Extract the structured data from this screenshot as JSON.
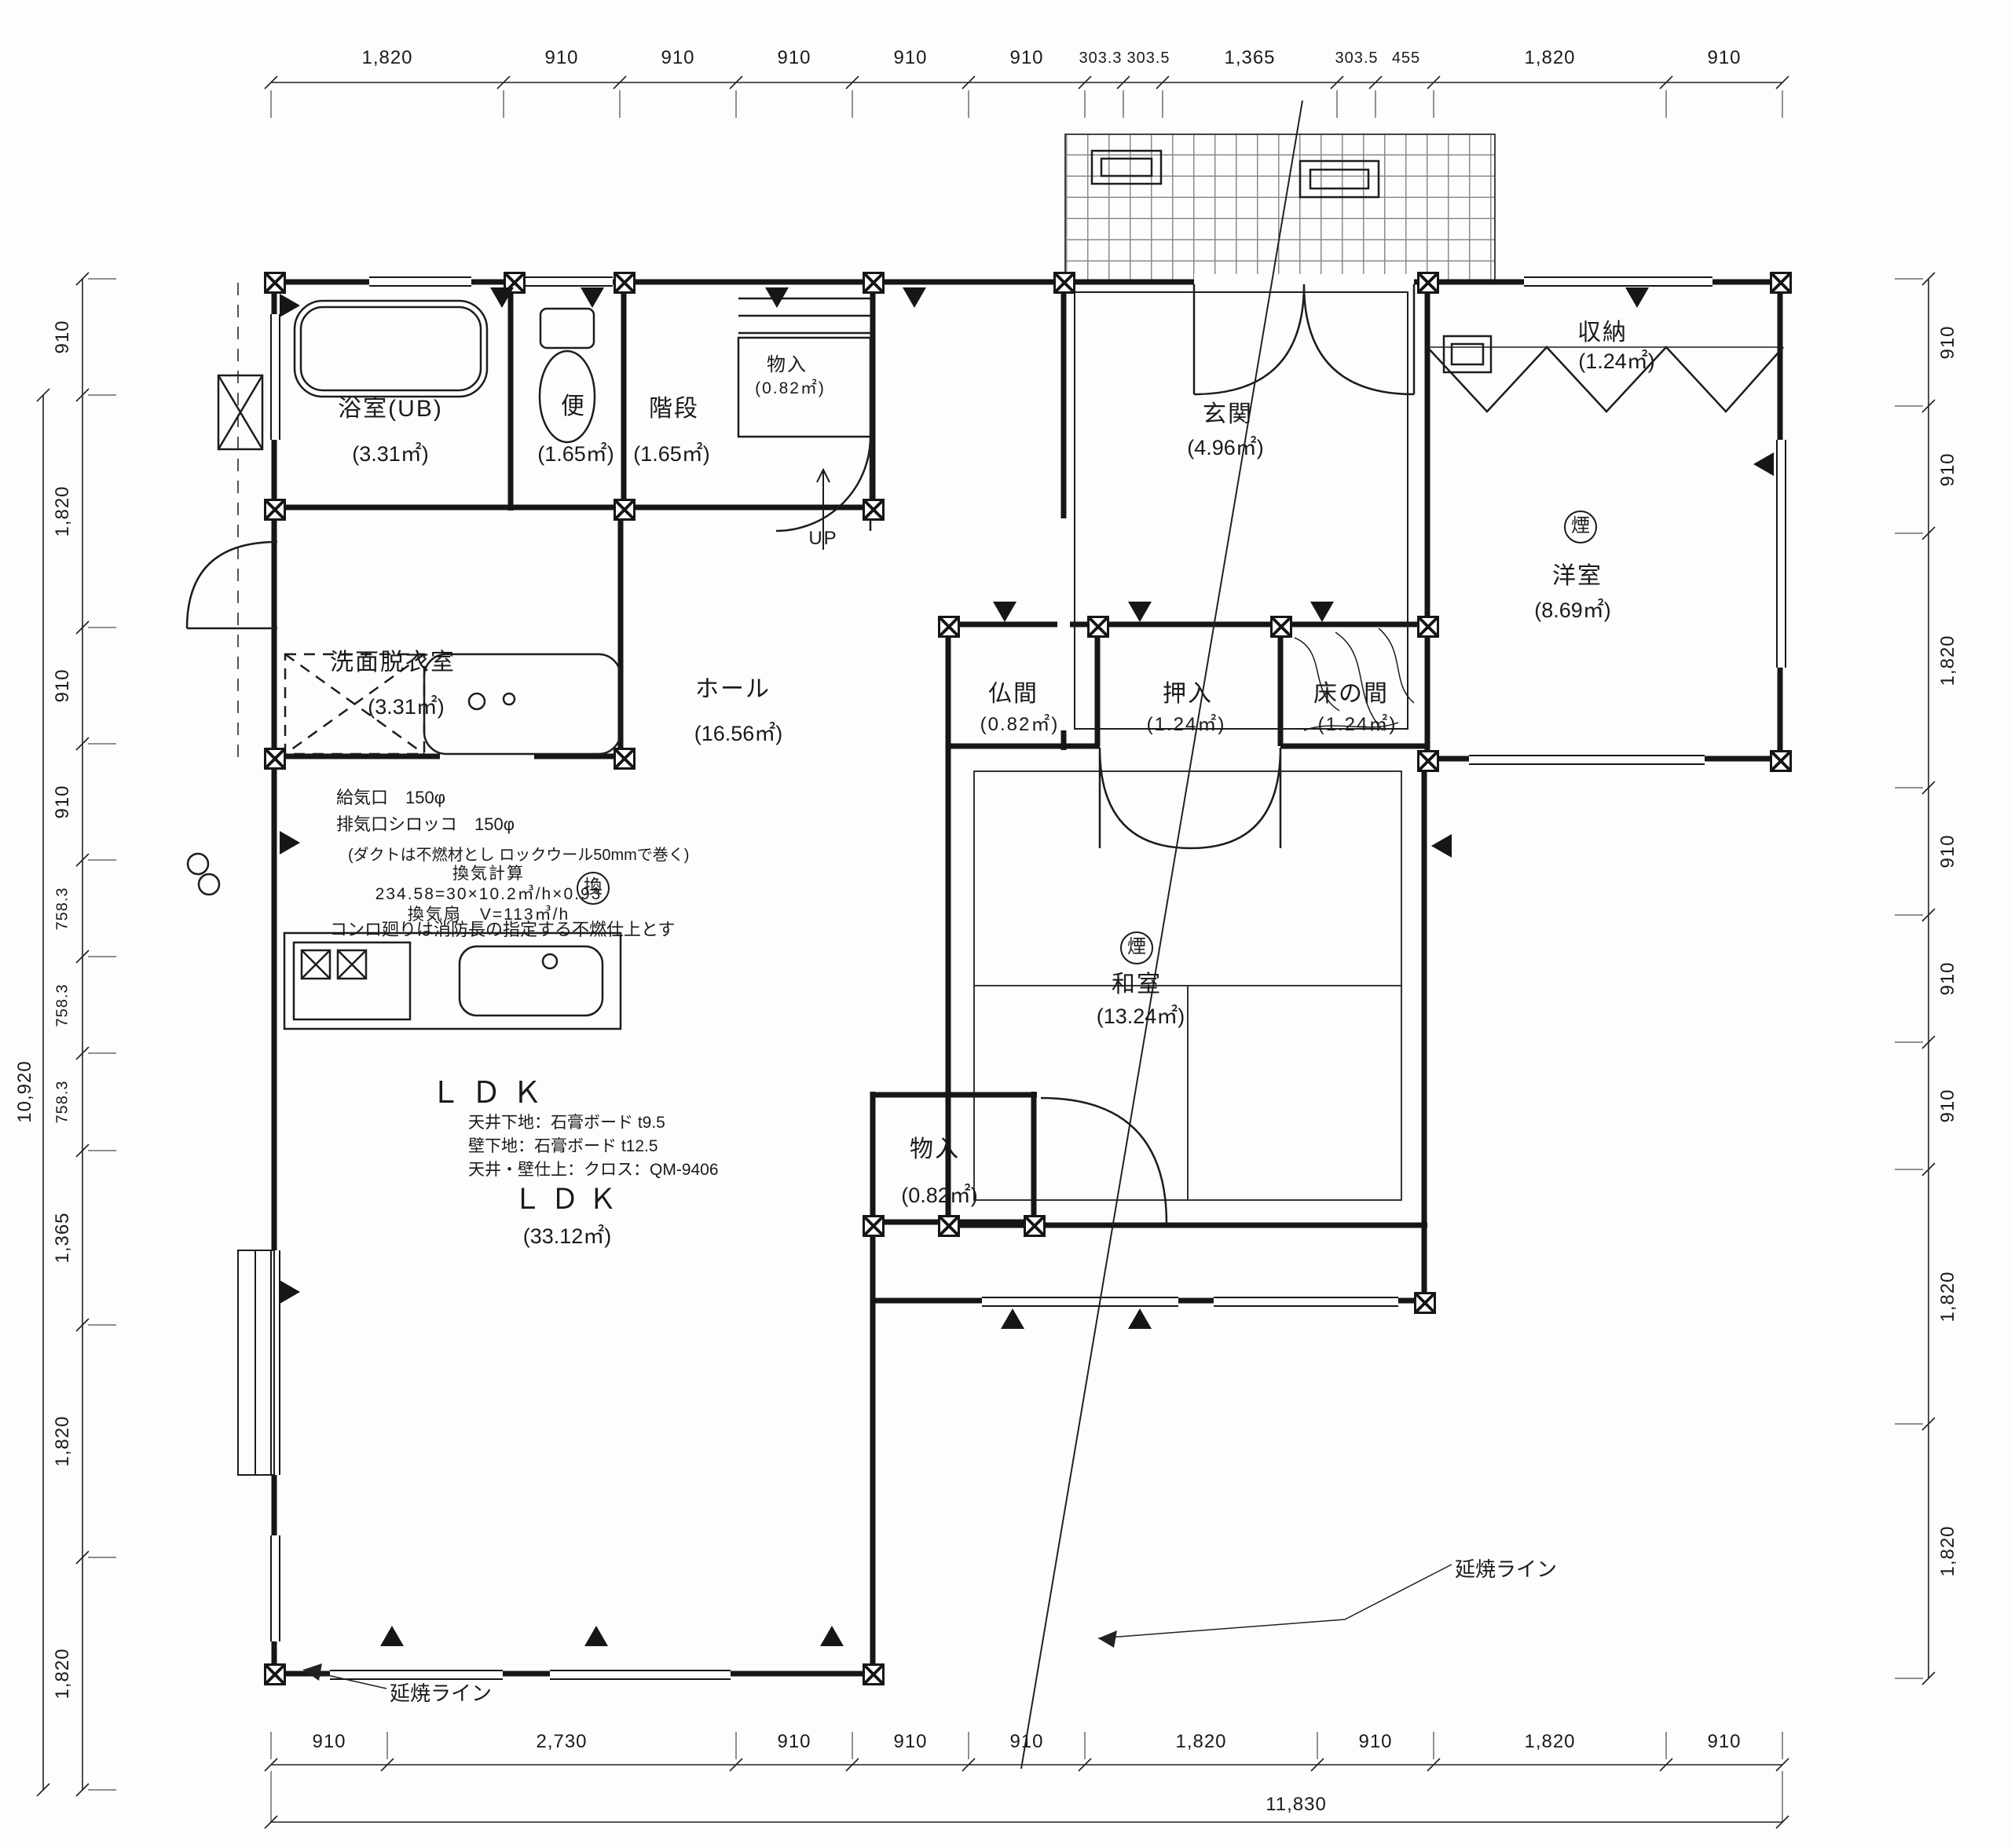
{
  "drawing": {
    "fire_line_label": "延焼ライン",
    "up_label": "UP",
    "smoke_detector_mark": "煙",
    "vent_mark": "換"
  },
  "rooms": {
    "bath": {
      "name": "浴室(UB)",
      "area": "(3.31㎡)"
    },
    "toilet": {
      "name": "便",
      "area": "(1.65㎡)"
    },
    "stairs": {
      "name": "階段",
      "area": "(1.65㎡)"
    },
    "stairs_closet": {
      "name": "物入",
      "area": "(0.82㎡)"
    },
    "genkan": {
      "name": "玄関",
      "area": "(4.96㎡)"
    },
    "shunou": {
      "name": "収納",
      "area": "(1.24㎡)"
    },
    "youshitsu": {
      "name": "洋室",
      "area": "(8.69㎡)"
    },
    "senmen": {
      "name": "洗面脱衣室",
      "area": "(3.31㎡)"
    },
    "hall": {
      "name": "ホール",
      "area": "(16.56㎡)"
    },
    "butsuma": {
      "name": "仏間",
      "area": "(0.82㎡)"
    },
    "oshiire": {
      "name": "押入",
      "area": "(1.24㎡)"
    },
    "tokonoma": {
      "name": "床の間",
      "area": "(1.24㎡)"
    },
    "washitsu": {
      "name": "和室",
      "area": "(13.24㎡)"
    },
    "ldk_closet": {
      "name": "物入",
      "area": "(0.82㎡)"
    },
    "ldk": {
      "name": "ＬＤＫ",
      "area": "(33.12㎡)"
    }
  },
  "ldk_spec": {
    "title": "ＬＤＫ",
    "line1": "天井下地：石膏ボード t9.5",
    "line2": "壁下地：石膏ボード t12.5",
    "line3": "天井・壁仕上：クロス：QM-9406"
  },
  "vent_notes": {
    "supply": "給気口　150φ",
    "exhaust": "排気口シロッコ　150φ",
    "duct": "(ダクトは不燃材とし ロックウール50mmで巻く)",
    "calc_title": "換気計算",
    "calc": "234.58=30×10.2㎥/h×0.93",
    "fan": "換気扇　V=113㎥/h",
    "konro": "コンロ廻りは消防長の指定する不燃仕上とす"
  },
  "dims": {
    "top": [
      "1,820",
      "910",
      "910",
      "910",
      "910",
      "910",
      "303.3",
      "303.5",
      "1,365",
      "303.5",
      "455",
      "1,820",
      "910"
    ],
    "bottom": [
      "910",
      "2,730",
      "910",
      "910",
      "910",
      "1,820",
      "910",
      "1,820",
      "910"
    ],
    "bottom_total": "11,830",
    "left": [
      "910",
      "1,820",
      "910",
      "910",
      "758.3",
      "758.3",
      "758.3",
      "1,365",
      "1,820",
      "1,820"
    ],
    "left_total": "10,920",
    "right": [
      "910",
      "910",
      "1,820",
      "910",
      "910",
      "910",
      "1,820",
      "1,820"
    ]
  }
}
